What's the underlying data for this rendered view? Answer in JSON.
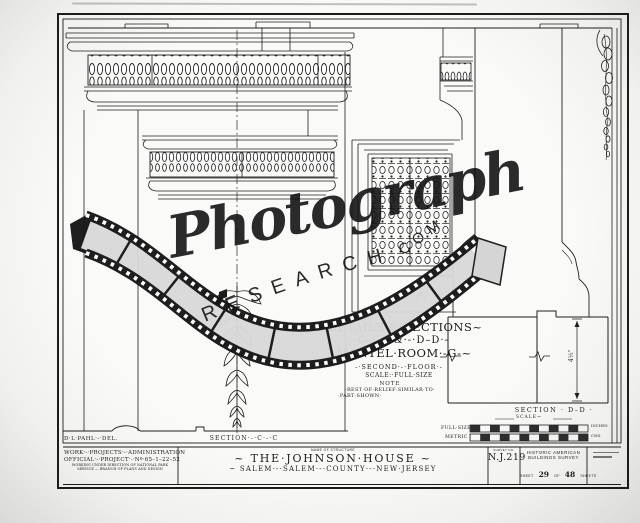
{
  "watermark": {
    "script": "Photograph",
    "research": "RESEARCH",
    "com": "·COM"
  },
  "drawing": {
    "title_line1": "~DETAILS·&·SECTIONS~",
    "title_line2": "-·C–C·-·&·-·D–D·-",
    "title_line3": "~MANTEL·ROOM·-G-~",
    "title_line4": "-·SECOND·-·FLOOR·-",
    "title_line5": "SCALE:·FULL·SIZE",
    "note_heading": "NOTE",
    "note_line1": "·REST·OF·RELIEF·SIMILAR·TO·",
    "note_line2": "·PART·SHOWN·",
    "section_cc": "SECTION·-·C·-·C",
    "section_dd": "SECTION · D–D ·",
    "delineator": "D·L·PAHL·-·DEL.",
    "dimension_dd": "4½\"",
    "scale_heading": "SCALE→",
    "scale_full_size": "FULL·SIZE",
    "scale_inches": "INCHES",
    "scale_metric": "METRIC",
    "scale_cms": "CMS."
  },
  "title_block": {
    "wpa_line1": "WORK·-·PROJECTS·-·ADMINISTRATION",
    "wpa_line2": "OFFICIAL·-·PROJECT·-·Nº·65–1–22–52",
    "wpa_line3": "WORKING UNDER DIRECTION OF NATIONAL PARK SERVICE — BRANCH OF PLANS AND DESIGN",
    "name_header": "NAME OF STRUCTURE",
    "structure_name": "~ THE·JOHNSON·HOUSE ~",
    "structure_location": "~  SALEM·-·SALEM·-·COUNTY·-·NEW·JERSEY",
    "survey_header": "SURVEY NO.",
    "survey_no": "N.J.219",
    "habs_line1": "HISTORIC AMERICAN",
    "habs_line2": "BUILDINGS SURVEY",
    "sheet_pre": "SHEET",
    "sheet_num": "29",
    "sheet_mid": "OF",
    "sheet_total": "48",
    "sheet_post": "SHEETS"
  }
}
